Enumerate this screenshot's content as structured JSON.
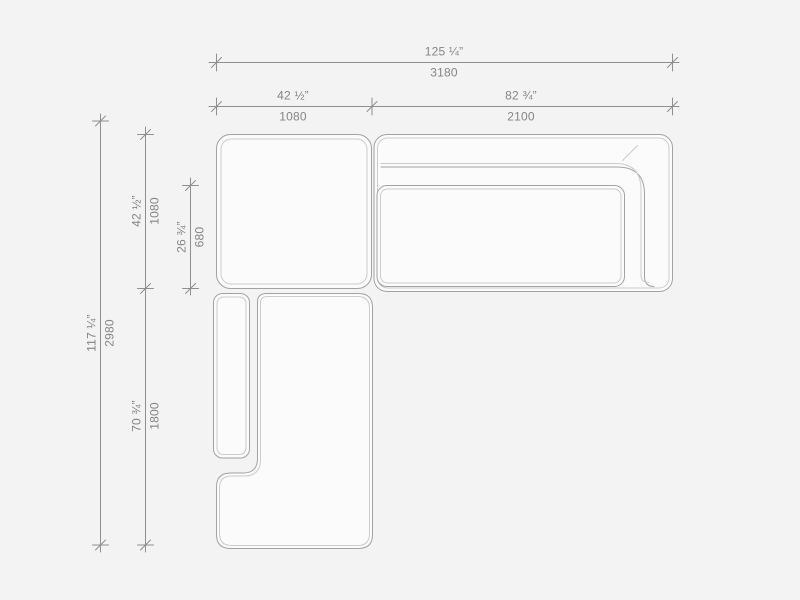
{
  "canvas": {
    "width": 800,
    "height": 600,
    "background": "#f3f3f4"
  },
  "drawing": {
    "title": "Sectional sofa plan view dimension drawing",
    "outline_color": "#a2a2a2",
    "inner_line_color": "#cbcbcb",
    "dimension_line_color": "#8f8f8f",
    "label_color": "#848484",
    "module_fill": "#fbfbfb",
    "modules": [
      {
        "name": "corner-module"
      },
      {
        "name": "sofa-section-with-back-and-right-arm"
      },
      {
        "name": "chaise-module-with-left-armrest"
      }
    ]
  },
  "dims": {
    "horizontal": [
      {
        "name": "overall-width",
        "inches": "125 ¼”",
        "mm": "3180"
      },
      {
        "name": "corner-module-width",
        "inches": "42 ½”",
        "mm": "1080"
      },
      {
        "name": "sofa-section-width",
        "inches": "82 ¾”",
        "mm": "2100"
      }
    ],
    "vertical": [
      {
        "name": "overall-depth",
        "inches": "117 ¼”",
        "mm": "2980"
      },
      {
        "name": "corner-module-depth",
        "inches": "42 ½”",
        "mm": "1080"
      },
      {
        "name": "seat-depth",
        "inches": "26 ¾”",
        "mm": "680"
      },
      {
        "name": "chaise-module-length",
        "inches": "70 ¾”",
        "mm": "1800"
      }
    ]
  }
}
